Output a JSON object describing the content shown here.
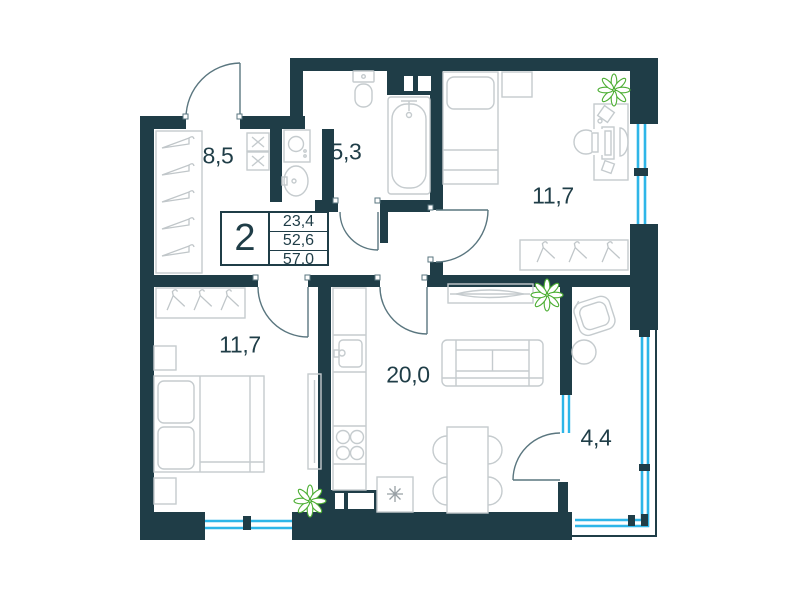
{
  "plan_title": "2-room apartment floor plan",
  "summary": {
    "rooms_count": "2",
    "values": [
      "23,4",
      "52,6",
      "57,0"
    ]
  },
  "rooms": {
    "hallway": "8,5",
    "bathroom": "5,3",
    "bedroom_top": "11,7",
    "bedroom_bottom": "11,7",
    "kitchen_living": "20,0",
    "balcony": "4,4"
  },
  "icons": {
    "plant": "plant-icon",
    "snowflake": "snowflake-icon",
    "hanger": "hanger-icon"
  },
  "colors": {
    "wall": "#1f3d47",
    "window": "#2eb6e8",
    "plant": "#4cae33",
    "furniture": "#c5cbce",
    "door": "#5a767f",
    "text": "#1f3d47"
  }
}
